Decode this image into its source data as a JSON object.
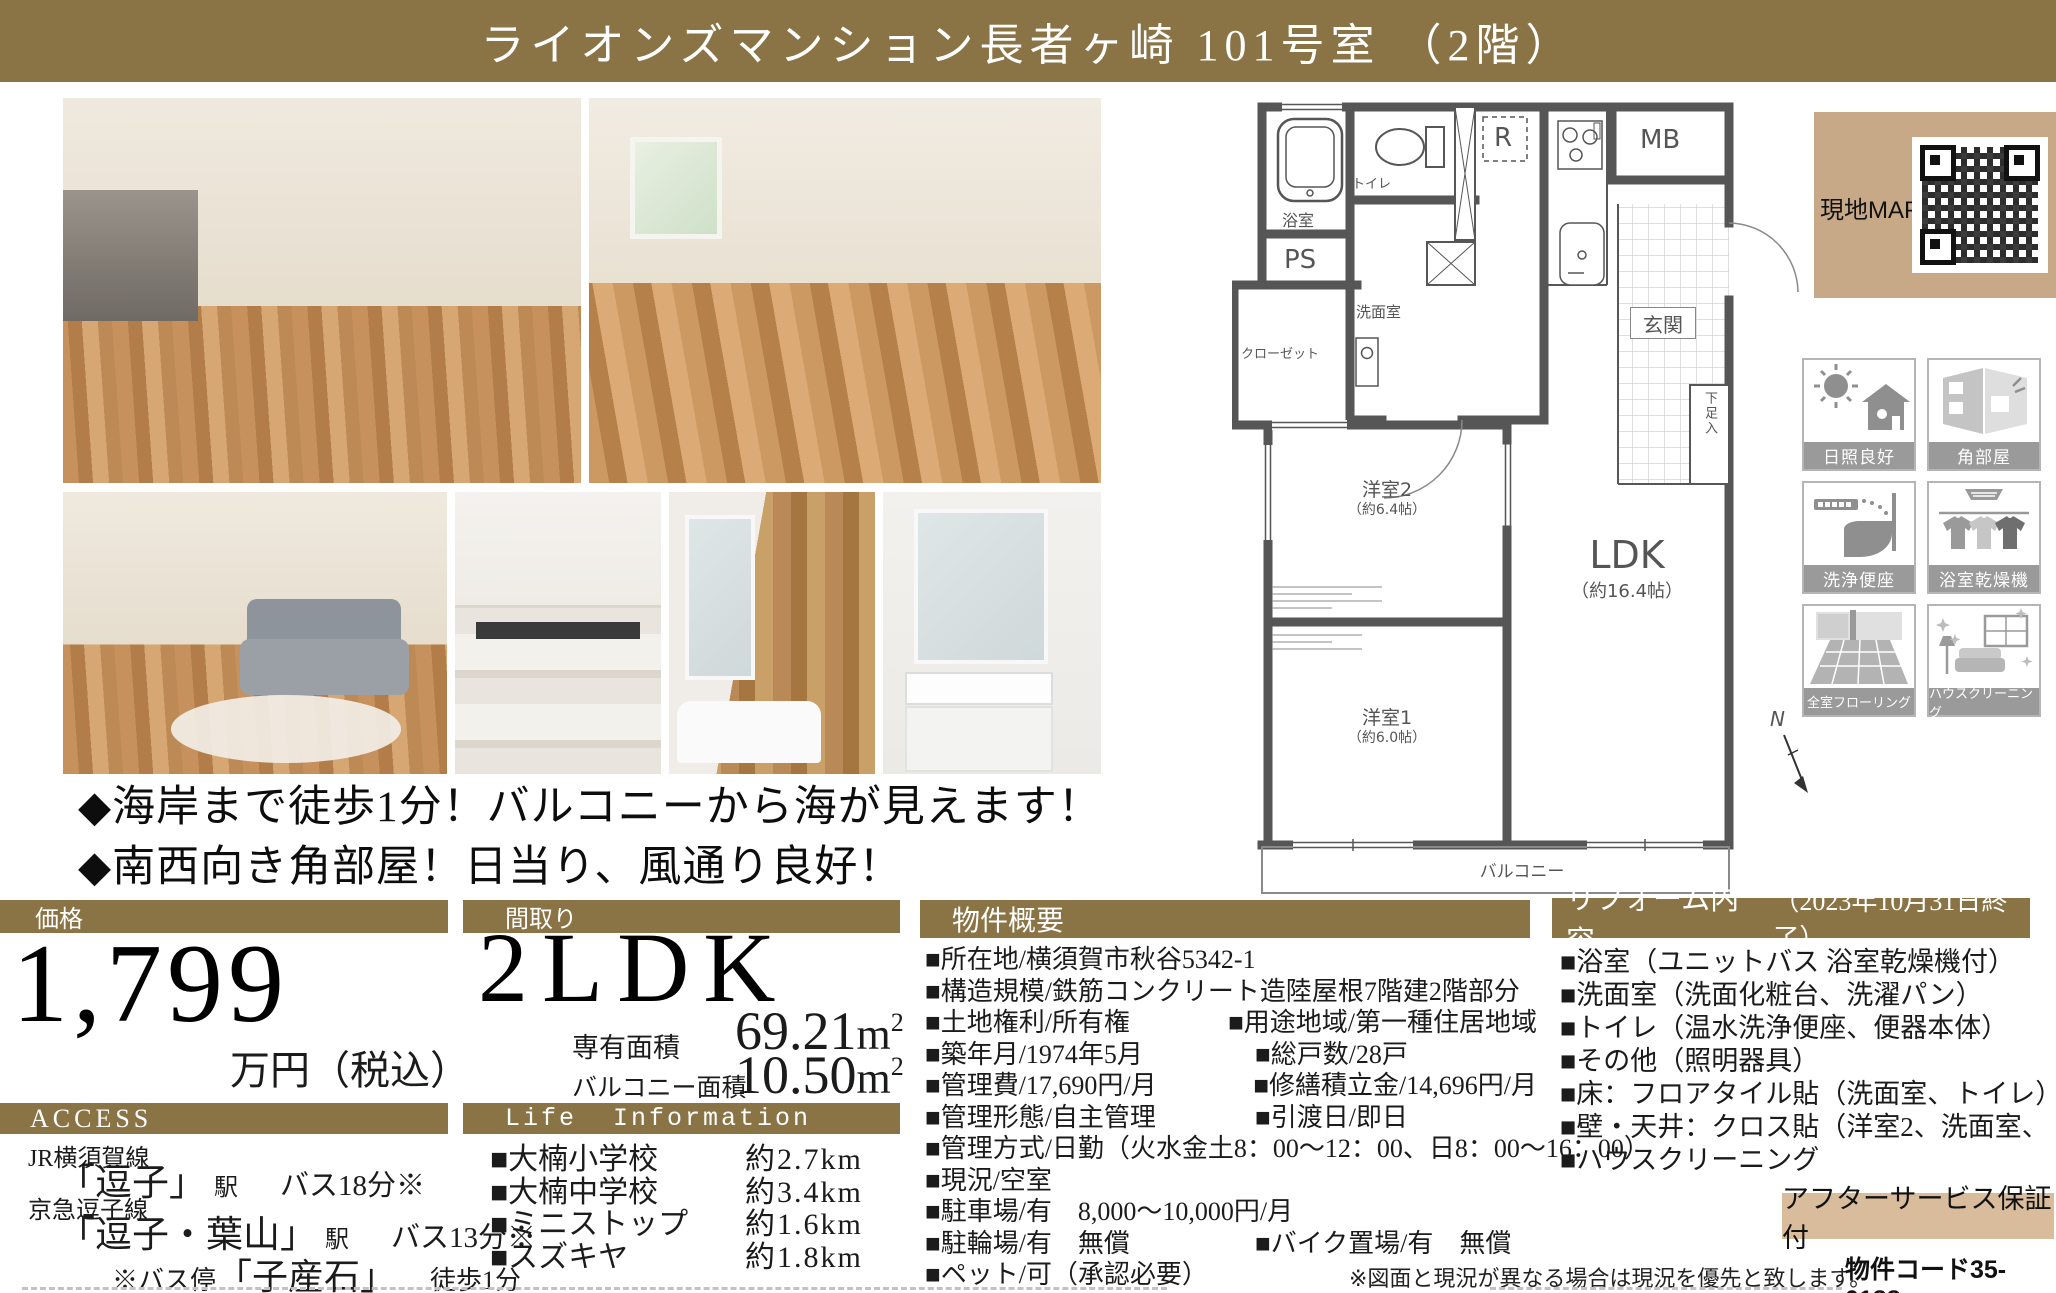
{
  "page": {
    "title": "ライオンズマンション長者ヶ崎 101号室 （2階）"
  },
  "catch_copy": {
    "line1": "◆海岸まで徒歩1分！バルコニーから海が見えます！",
    "line2": "◆南西向き角部屋！日当り、風通り良好！"
  },
  "map_panel": {
    "label": "現地MAP"
  },
  "features": {
    "items": [
      {
        "label": "日照良好"
      },
      {
        "label": "角部屋"
      },
      {
        "label": "洗浄便座"
      },
      {
        "label": "浴室乾燥機"
      },
      {
        "label": "全室フローリング"
      },
      {
        "label": "ハウスクリーニング"
      }
    ]
  },
  "floor_plan": {
    "labels": {
      "bath": "浴室",
      "toilet": "トイレ",
      "refrigerator": "R",
      "meter_box": "MB",
      "pipe_space": "PS",
      "washroom": "洗面室",
      "closet": "クローゼット",
      "entrance": "玄関",
      "shoe_box": "下足入",
      "bedroom2": "洋室2",
      "bedroom2_size": "（約6.4帖）",
      "ldk": "LDK",
      "ldk_size": "（約16.4帖）",
      "bedroom1": "洋室1",
      "bedroom1_size": "（約6.0帖）",
      "balcony": "バルコニー",
      "compass_n": "N"
    }
  },
  "price": {
    "header": "価格",
    "amount": "1,799",
    "unit": "万円（税込）"
  },
  "access": {
    "header": "ACCESS",
    "lines": [
      {
        "rail": "JR横須賀線",
        "station": "「逗子」",
        "suffix": "駅",
        "note": "バス18分※"
      },
      {
        "rail": "京急逗子線",
        "station": "「逗子・葉山」",
        "suffix": "駅",
        "note": "バス13分※"
      }
    ],
    "bus_note": {
      "prefix": "※バス停",
      "stop": "「子産石」",
      "walk": "徒歩1分"
    }
  },
  "madori": {
    "header": "間取り",
    "type": "2LDK",
    "area_label": "専有面積",
    "area_value": "69.21",
    "balcony_label": "バルコニー面積",
    "balcony_value": "10.50",
    "unit": "m",
    "unit_sup": "2"
  },
  "life_info": {
    "header": "Life Information",
    "items": [
      {
        "name": "■大楠小学校",
        "distance": "約2.7km"
      },
      {
        "name": "■大楠中学校",
        "distance": "約3.4km"
      },
      {
        "name": "■ミニストップ",
        "distance": "約1.6km"
      },
      {
        "name": "■スズキヤ",
        "distance": "約1.8km"
      }
    ]
  },
  "outline": {
    "header": "物件概要",
    "rows": [
      {
        "left": "■所在地/横須賀市秋谷5342-1",
        "right": ""
      },
      {
        "left": "■構造規模/鉄筋コンクリート造陸屋根7階建2階部分",
        "right": ""
      },
      {
        "left": "■土地権利/所有権",
        "right": "■用途地域/第一種住居地域"
      },
      {
        "left": "■築年月/1974年5月",
        "right": "■総戸数/28戸"
      },
      {
        "left": "■管理費/17,690円/月",
        "right": "■修繕積立金/14,696円/月"
      },
      {
        "left": "■管理形態/自主管理",
        "right": "■引渡日/即日"
      },
      {
        "left": "■管理方式/日勤（火水金土8：00～12：00、日8：00～16：00）",
        "right": ""
      },
      {
        "left": "■現況/空室",
        "right": ""
      },
      {
        "left": "■駐車場/有　8,000～10,000円/月",
        "right": ""
      },
      {
        "left": "■駐輪場/有　無償",
        "right": "■バイク置場/有　無償"
      },
      {
        "left": "■ペット/可（承認必要）",
        "right": ""
      }
    ]
  },
  "reform": {
    "header": "リフォーム内容",
    "header_note": "（2023年10月31日終了）",
    "items": [
      "■浴室（ユニットバス 浴室乾燥機付）",
      "■洗面室（洗面化粧台、洗濯パン）",
      "■トイレ（温水洗浄便座、便器本体）",
      "■その他（照明器具）",
      "■床：フロアタイル貼（洗面室、トイレ）",
      "■壁・天井：クロス貼（洋室2、洗面室、トイレ）",
      "■ハウスクリーニング"
    ]
  },
  "footer": {
    "after_service": "アフターサービス保証付",
    "disclaimer": "※図面と現況が異なる場合は現況を優先と致します。",
    "property_code": "物件コード35-0188"
  }
}
